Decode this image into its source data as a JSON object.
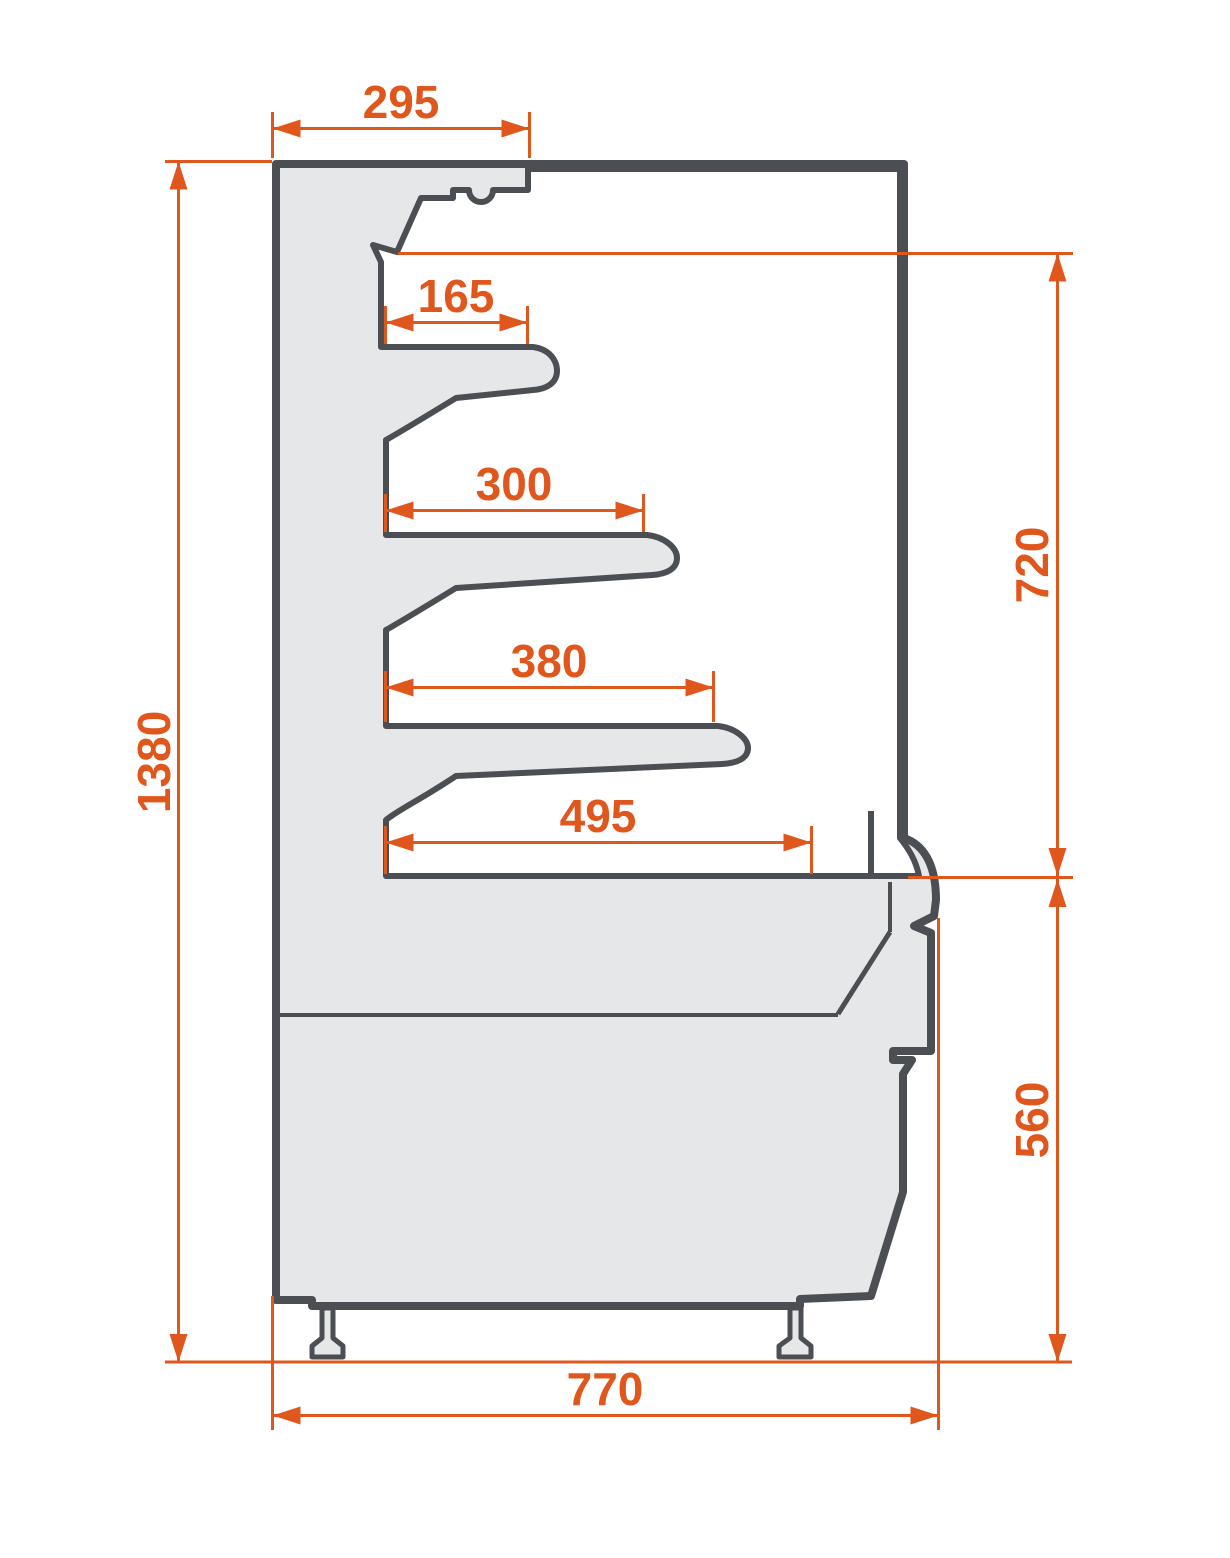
{
  "drawing": {
    "kind": "side-section technical drawing",
    "dimensions": {
      "top_depth": {
        "value": "295"
      },
      "shelf_1_depth": {
        "value": "165"
      },
      "shelf_2_depth": {
        "value": "300"
      },
      "shelf_3_depth": {
        "value": "380"
      },
      "base_shelf_depth": {
        "value": "495"
      },
      "overall_height": {
        "value": "1380"
      },
      "opening_height": {
        "value": "720"
      },
      "base_height": {
        "value": "560"
      },
      "overall_depth": {
        "value": "770"
      }
    }
  },
  "colors": {
    "accent": "#E0571D",
    "outline": "#4B4F54",
    "fill": "#E6E7E9",
    "cavity": "#FFFFFF",
    "background": "#FFFFFF"
  }
}
